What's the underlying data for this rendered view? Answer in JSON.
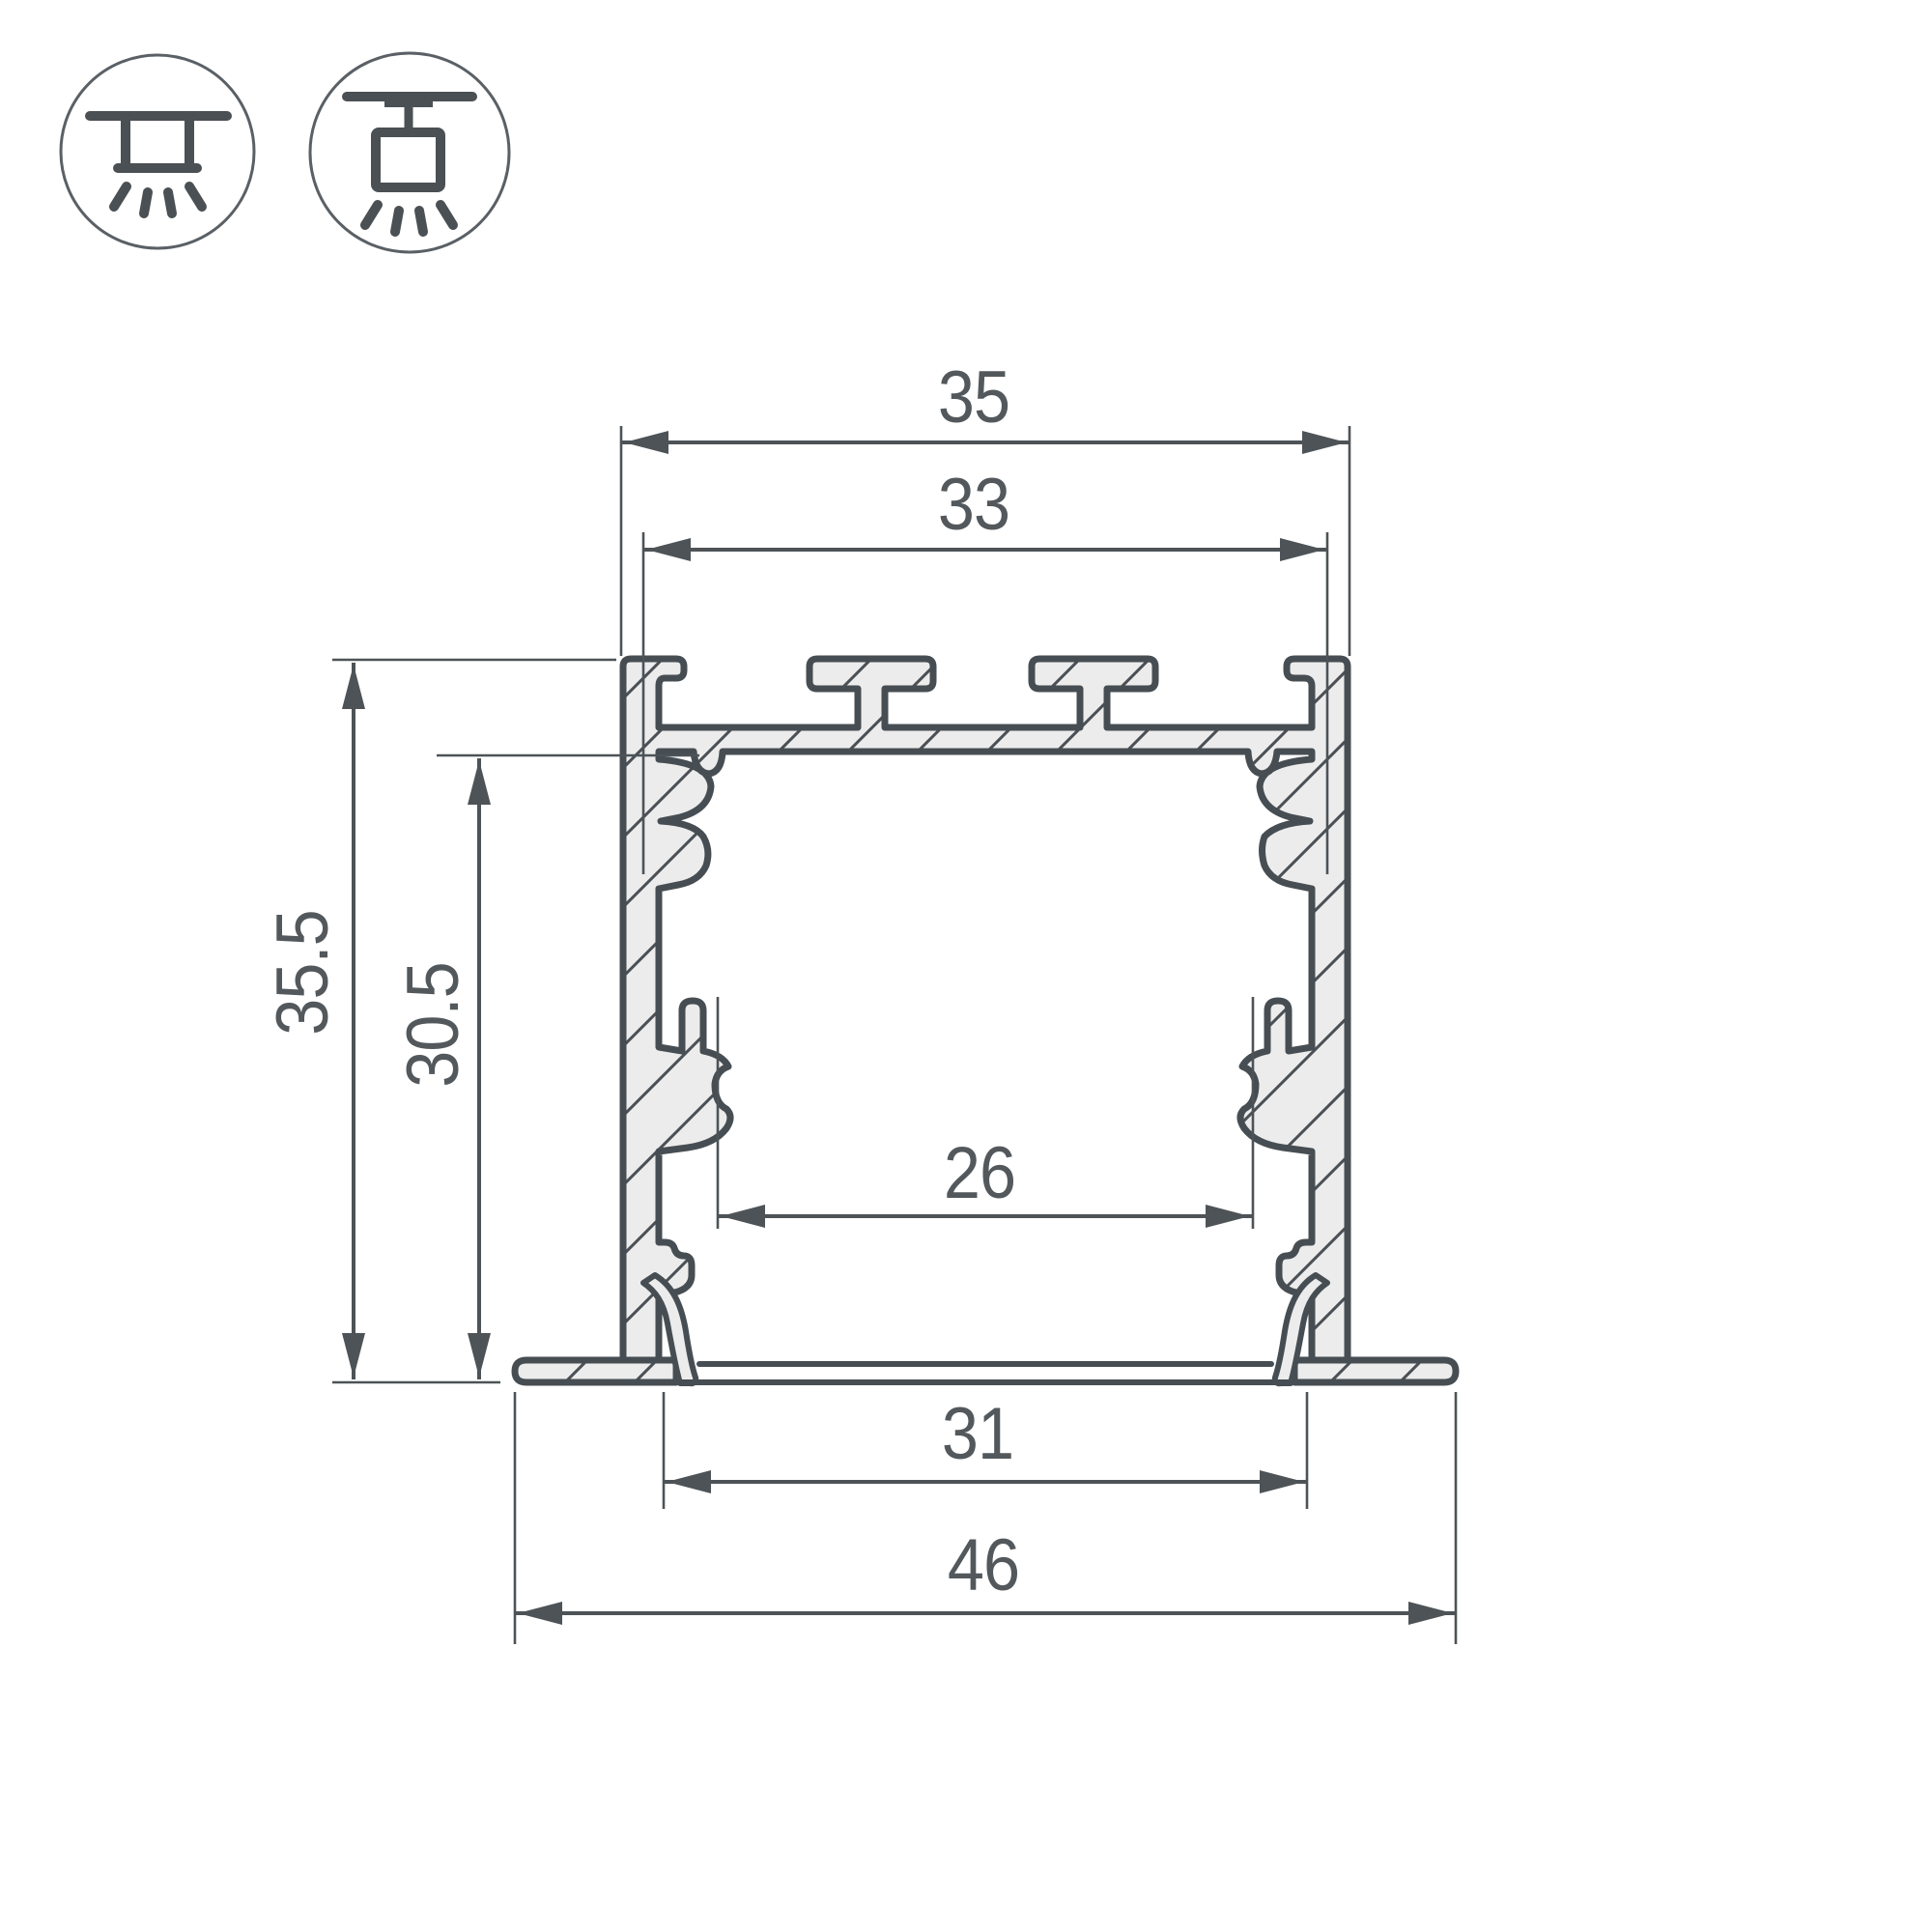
{
  "drawing": {
    "type": "technical-cross-section",
    "subject": "recessed aluminum LED profile cross-section with dimension lines",
    "units": "mm"
  },
  "colors": {
    "background": "#ffffff",
    "outline": "#474e53",
    "aluminum_fill": "#ececec",
    "dimension": "#53585c",
    "icon_stroke": "#4a5054"
  },
  "icons": [
    {
      "name": "recessed-mounting-icon",
      "meaning": "recessed ceiling mount luminaire"
    },
    {
      "name": "surface-mounting-icon",
      "meaning": "surface ceiling mount luminaire"
    }
  ],
  "dims": {
    "top_width": "35",
    "top_inner_width": "33",
    "overall_height": "35.5",
    "inner_height": "30.5",
    "inner_width": "26",
    "bottom_inner_width": "31",
    "overall_width": "46"
  }
}
